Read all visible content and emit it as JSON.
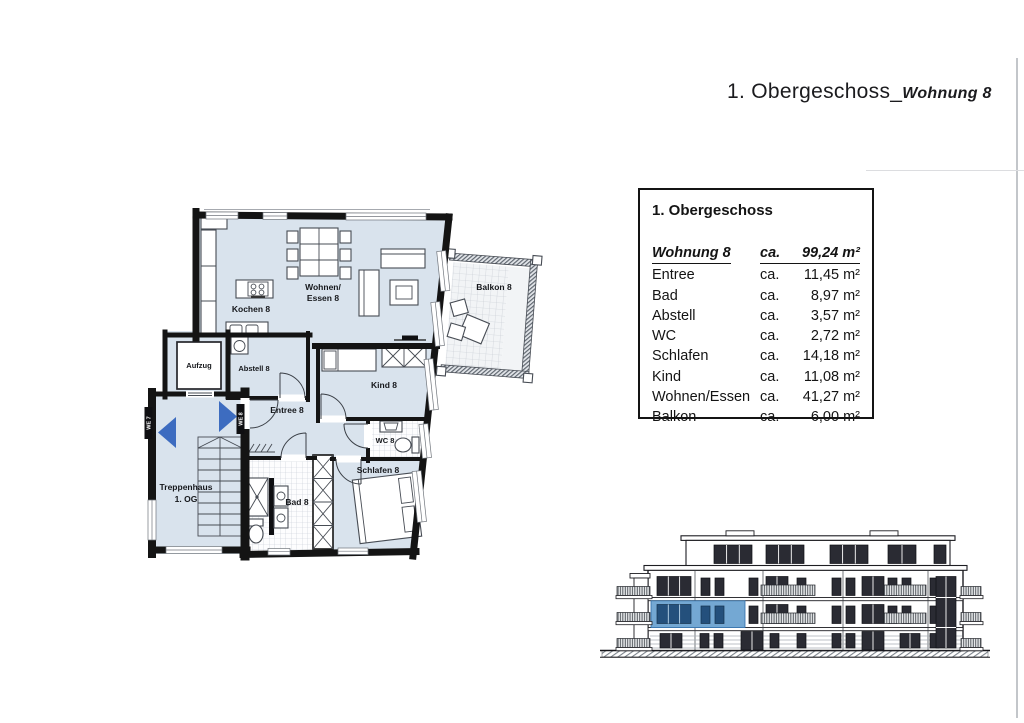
{
  "title": {
    "main": "1. Obergeschoss_",
    "sub": "Wohnung 8"
  },
  "info_box": {
    "heading": "1. Obergeschoss",
    "header": {
      "label": "Wohnung 8",
      "ca": "ca.",
      "value": "99,24",
      "unit": "m²"
    },
    "rows": [
      {
        "label": "Entree",
        "ca": "ca.",
        "value": "11,45",
        "unit": "m²"
      },
      {
        "label": "Bad",
        "ca": "ca.",
        "value": "8,97",
        "unit": "m²"
      },
      {
        "label": "Abstell",
        "ca": "ca.",
        "value": "3,57",
        "unit": "m²"
      },
      {
        "label": "WC",
        "ca": "ca.",
        "value": "2,72",
        "unit": "m²"
      },
      {
        "label": "Schlafen",
        "ca": "ca.",
        "value": "14,18",
        "unit": "m²"
      },
      {
        "label": "Kind",
        "ca": "ca.",
        "value": "11,08",
        "unit": "m²"
      },
      {
        "label": "Wohnen/Essen",
        "ca": "ca.",
        "value": "41,27",
        "unit": "m²"
      },
      {
        "label": "Balkon",
        "ca": "ca.",
        "value": "6,00",
        "unit": "m²"
      }
    ]
  },
  "floorplan": {
    "rooms": {
      "kochen": "Kochen 8",
      "wohnen1": "Wohnen/",
      "wohnen2": "Essen 8",
      "balkon": "Balkon 8",
      "abstell": "Abstell 8",
      "aufzug": "Aufzug",
      "entree": "Entree 8",
      "kind": "Kind 8",
      "wc": "WC 8",
      "schlafen": "Schlafen 8",
      "bad": "Bad 8",
      "trepp1": "Treppenhaus",
      "trepp2": "1. OG",
      "we7": "WE 7",
      "we8": "WE 8"
    }
  },
  "colors": {
    "floor": "#d9e3ed",
    "wall": "#141414",
    "marker_blue": "#3d6cc0",
    "highlight_fill": "#74a8d3",
    "highlight_window": "#24507c"
  }
}
